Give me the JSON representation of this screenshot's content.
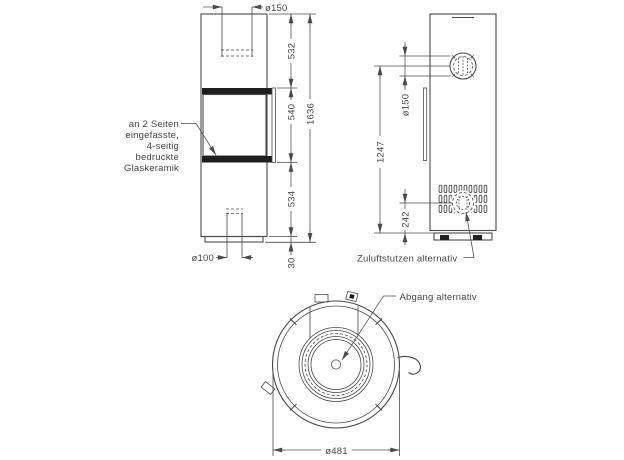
{
  "drawing": {
    "front": {
      "note": {
        "line1": "an 2 Seiten",
        "line2": "eingefasste,",
        "line3": "4-seitig",
        "line4": "bedruckte",
        "line5": "Glaskeramik"
      },
      "dim_flue_diameter": "ø150",
      "dim_upper": "532",
      "dim_window": "540",
      "dim_lower": "534",
      "dim_total": "1636",
      "dim_base_height": "30",
      "dim_air_diameter": "ø100"
    },
    "side": {
      "dim_flue_diameter": "ø150",
      "dim_flue_center_height": "1247",
      "dim_air_center_height": "242",
      "air_inlet_label": "Zuluftstutzen alternativ"
    },
    "top": {
      "outlet_label": "Abgang alternativ",
      "dim_outer_diameter": "ø481"
    }
  }
}
